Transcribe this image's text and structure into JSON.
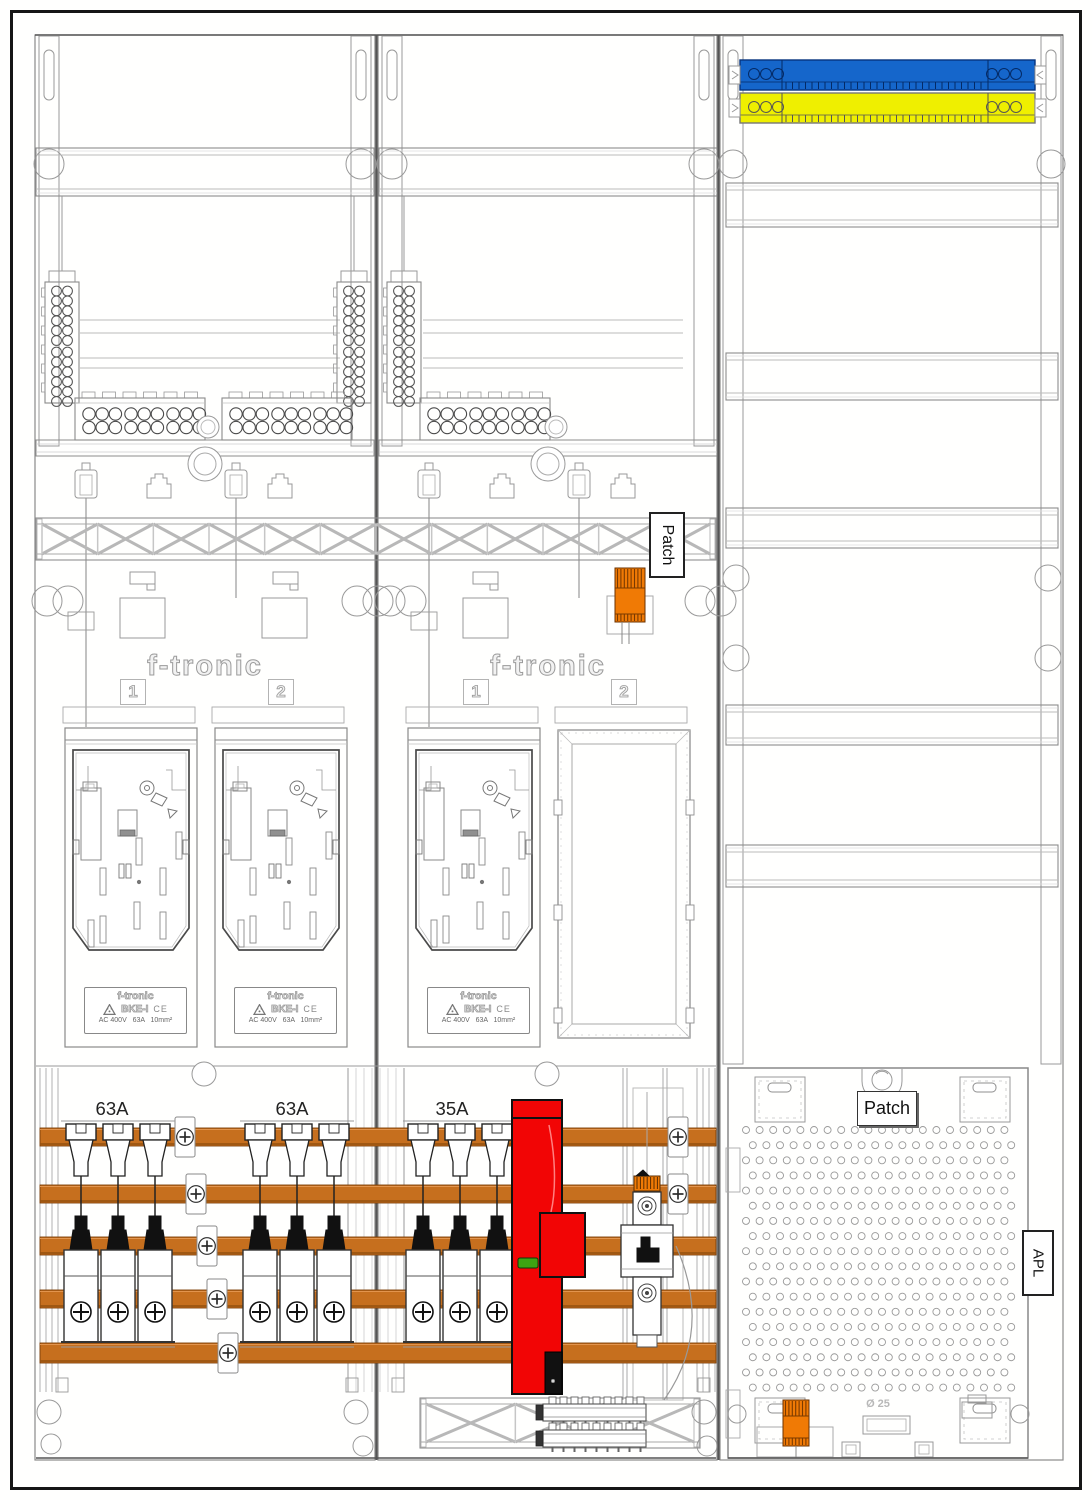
{
  "labels": {
    "patch": "Patch",
    "apl": "APL",
    "diameter": "Ø 25"
  },
  "meter_panels": {
    "brand": "f-tronic",
    "field_numbers": [
      "1",
      "2"
    ],
    "nameplate": {
      "brand": "f-tronic",
      "model": "BKE-I",
      "ce_mark": "CE",
      "ratings": "AC 400V   63A   10mm²"
    }
  },
  "breaker_ratings": [
    "63A",
    "63A",
    "35A"
  ],
  "colors": {
    "busbar_copper": "#C66F1E",
    "terminal_orange": "#F07A05",
    "device_red": "#F20505",
    "led_green": "#3DA412",
    "neutral_blue": "#1566CB",
    "pe_yellow": "#EFEF00",
    "line_gray": "#999999"
  }
}
